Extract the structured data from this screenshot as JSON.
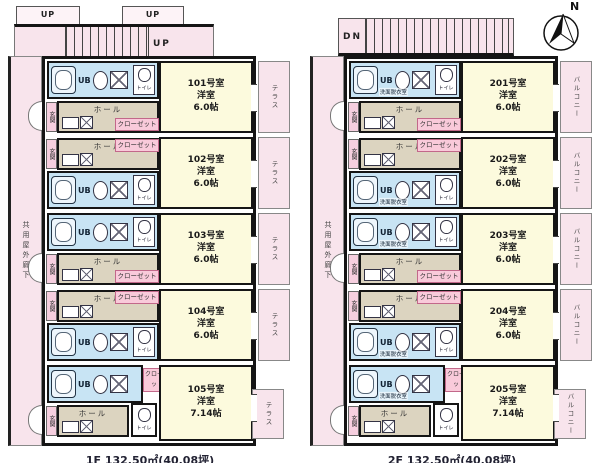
{
  "compass": {
    "north_label": "N"
  },
  "floors": [
    {
      "name": "1F",
      "caption": "1F 132.50㎡(40.08坪)",
      "stair_label": "UP",
      "stub_labels": [
        "UP",
        "UP"
      ],
      "corridor_label": "共用屋外廊下",
      "outdoor_label": "テラス",
      "labels": {
        "ub": "UB",
        "toilet": "トイレ",
        "hall": "ホール",
        "closet": "クローゼット",
        "entrance": "玄関"
      },
      "units": [
        {
          "no": "101号室",
          "type": "洋室",
          "size": "6.0帖"
        },
        {
          "no": "102号室",
          "type": "洋室",
          "size": "6.0帖"
        },
        {
          "no": "103号室",
          "type": "洋室",
          "size": "6.0帖"
        },
        {
          "no": "104号室",
          "type": "洋室",
          "size": "6.0帖"
        },
        {
          "no": "105号室",
          "type": "洋室",
          "size": "7.14帖"
        }
      ]
    },
    {
      "name": "2F",
      "caption": "2F 132.50㎡(40.08坪)",
      "stair_label": "DN",
      "stub_labels": [],
      "corridor_label": "共用屋外廊下",
      "outdoor_label": "バルコニー",
      "labels": {
        "ub": "UB",
        "toilet": "トイレ",
        "hall": "ホール",
        "closet": "クローゼット",
        "entrance": "玄関",
        "washroom": "洗面脱衣室"
      },
      "units": [
        {
          "no": "201号室",
          "type": "洋室",
          "size": "6.0帖"
        },
        {
          "no": "202号室",
          "type": "洋室",
          "size": "6.0帖"
        },
        {
          "no": "203号室",
          "type": "洋室",
          "size": "6.0帖"
        },
        {
          "no": "204号室",
          "type": "洋室",
          "size": "6.0帖"
        },
        {
          "no": "205号室",
          "type": "洋室",
          "size": "7.14帖"
        }
      ]
    }
  ]
}
